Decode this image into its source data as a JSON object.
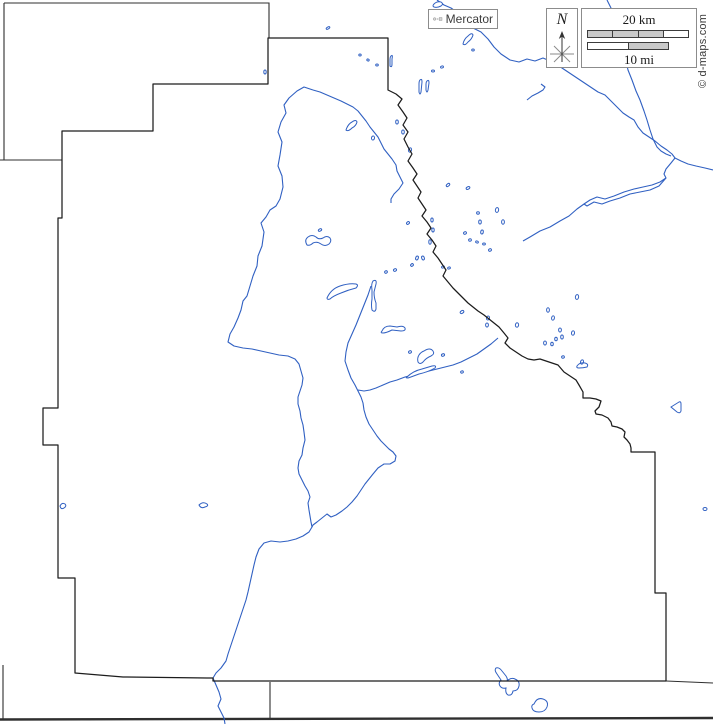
{
  "legend": {
    "projection": {
      "label": "Mercator"
    },
    "compass": {
      "label": "N"
    },
    "scale": {
      "km_label": "20 km",
      "mi_label": "10 mi",
      "km_segments": [
        "#c9c9c9",
        "#c9c9c9",
        "#c9c9c9",
        "#ffffff"
      ],
      "mi_segments": [
        "#ffffff",
        "#c9c9c9"
      ]
    },
    "copyright": "© d-maps.com"
  },
  "colors": {
    "river": "#3060c2",
    "water_fill": "#ffffff",
    "boundary": "#1c1c1c",
    "neighbor": "#2f2f2f",
    "legend_border": "#8c8c8c",
    "icon_fill": "#d4d4d4",
    "icon_stroke": "#6e6e6e"
  },
  "geometry": {
    "county_boundary": {
      "d": "M388 38 L388 90 L396 94 L402 99 L398 105 L403 112 L407 118 L403 125 L408 132 L404 139 L408 147 L412 154 L408 161 L413 168 L417 174 L413 180 L417 186 L421 192 L418 198 L422 204 L426 210 L422 216 L427 222 L431 228 L427 234 L432 240 L436 246 L433 252 L438 258 L442 264 L446 270 L443 276 L448 282 L453 288 L458 293 L463 298 L468 303 L473 307 L478 311 L484 315 L489 319 L494 323 L499 327 L504 333 L508 338 L505 343 L510 348 L516 352 L522 356 L528 359 L534 360 L540 359 L546 361 L552 363 L558 365 L564 372 L570 376 L576 380 L579 385 L583 392 L583 398 L590 398 L596 399 L601 401 L599 407 L595 411 L596 414 L602 415 L608 418 L611 422 L612 426 L617 427 L622 429 L625 432 L624 437 L627 440 L630 444 L631 448 L631 452 L655 452 L655 593 L666 593 L666 681 L213 681 L213 678 L207 678 L123 677 L75 673 L75 578 L58 578 L58 445 L43 445 L43 408 L58 408 L58 218 L62 218 L62 131 L153 131 L153 84 L268 84 L268 38 Z",
      "width": 1.25
    },
    "neighbor_lines": [
      {
        "name": "north-neighbor-top",
        "d": "M4 3 L269 3 L269 38",
        "w": 1.1
      },
      {
        "name": "northwest-edge",
        "d": "M4 3 L4 160",
        "w": 1.1
      },
      {
        "name": "west-neighbor",
        "d": "M0 160 L62 160",
        "w": 1.1
      },
      {
        "name": "southeast-extension",
        "d": "M666 681 L713 683",
        "w": 1.1
      },
      {
        "name": "south-neighbor-vertical",
        "d": "M270 682 L270 719",
        "w": 1.1
      },
      {
        "name": "southwest-edge",
        "d": "M3 665 L3 719",
        "w": 1.1
      },
      {
        "name": "south-thick-line",
        "d": "M0 719.5 L713 718",
        "w": 2.4
      }
    ],
    "rivers": [
      {
        "name": "northeast-main-river",
        "points": "437,0 444,5 451,8 458,13 465,21 473,28 481,32 488,39 494,47 501,54 510,60 519,62 527,59 535,61 543,58 550,61 556,64 562,68 568,72 574,76 580,80 586,84 592,88 598,92 605,95 612,102 618,108 623,113 629,117 634,120 638,127 643,133 649,137 655,141 661,146 667,150 672,154 675,158 681,161 688,164 696,166 705,168 713,170"
      },
      {
        "name": "north-tributary",
        "points": "607,0 611,8 615,14 619,22 622,32 620,42 624,52 626,62 628,70 632,80 636,91 640,100 644,111 647,120 650,130 653,139 657,147 661,151 666,154 671,156"
      },
      {
        "name": "southwest-branch",
        "points": "675,158 671,163 666,169 664,174 666,178 660,182 652,185 643,187 634,189 624,192 614,196 605,199 597,197 590,200 584,204 577,209 569,216 560,221 550,227 540,231 530,237 523,241"
      },
      {
        "name": "southwest-branch-braid",
        "points": "666,178 659,186 650,190 640,192 630,194 620,198 610,201 602,204 594,202 587,206 584,204"
      },
      {
        "name": "west-main-river",
        "points": "313,90 304,87 297,91 289,98 284,105 286,113 281,122 278,132 282,142 280,155 278,166 282,176 283,187 280,199 276,206 270,210 266,217 261,223 264,232 262,246 258,256 257,266 253,276 250,286 247,296 243,301 241,310 238,318 234,327 230,334 228,342 234,346 243,348 252,349 261,351 270,353 279,355 288,356 295,359 299,364 301,371 303,378 302,385 300,391 298,397 298,404 300,411 301,418 303,425 304,432 305,440 303,448 302,455 299,461 298,468 299,474 302,480 305,486 308,491 310,497 308,503 309,510 310,516 311,522 312,527 309,532 303,536 296,539 288,541 280,542 271,541 264,543 259,549 256,557 254,565 252,574 250,583 248,592 246,600 243,609 240,618 237,627 234,636 231,645 228,654 226,661 221,668 216,673 213,678 216,685 219,692 221,699 218,706 221,712 224,718 225,724"
      },
      {
        "name": "west-river-east-leg",
        "points": "313,90 320,92 327,95 334,98 341,101 347,104 353,107 358,111 362,116 366,121 370,127 374,132 378,137 381,143 384,149 388,154 392,159 396,165 397,171 400,177 403,183 399,189 394,194 391,199 391,203"
      },
      {
        "name": "center-river",
        "points": "371,286 368,295 364,305 360,315 356,325 352,334 348,343 346,352 345,361 348,370 351,378 355,385 358,391 361,397 363,403 364,410 366,417 369,424 373,430 377,436 381,441 385,445 389,449 393,452 396,456 395,461 390,464 384,464 378,468 373,474 369,479 365,484 361,490 357,496 352,502 347,507 342,511 336,515 331,517 327,514 322,518 317,522 313,525 312,527"
      },
      {
        "name": "southwest-feeder",
        "points": "498,338 491,344 484,349 477,354 469,358 461,362 453,365 445,367 437,369 429,371 421,373 413,375 405,377 397,380 390,382 383,385 376,388 370,390 364,391 358,390"
      },
      {
        "name": "small-squiggle-stream",
        "points": "527,100 532,96 538,93 543,90 545,87 541,84"
      }
    ],
    "lake_paths": [
      {
        "name": "dumbbell-lake",
        "d": "M307 245 Q304 240 308 237 Q312 234 316 237 Q319 240 323 238 Q327 235 330 238 Q332 241 329 244 Q325 247 321 244 Q317 241 313 243 Q310 246 307 245 Z"
      },
      {
        "name": "banana-lake",
        "d": "M327 298 Q331 289 340 286 Q349 283 356 284 Q359 285 356 288 Q348 290 341 293 Q333 296 330 299 Q327 300 327 298 Z"
      },
      {
        "name": "vertical-sliver-lake",
        "d": "M373 281 Q377 279 376 284 L374 292 Q374 298 376 303 L376 309 Q375 313 372 310 Q371 305 372 299 L372 290 Q371 284 373 281 Z"
      },
      {
        "name": "horizontal-sliver-lake",
        "d": "M382 331 Q384 326 390 326 L397 327 Q403 325 405 328 Q406 331 401 331 L392 330 Q386 333 383 333 Q380 333 382 331 Z"
      },
      {
        "name": "c-curl-lake",
        "d": "M424 351 Q430 347 433 351 Q435 354 431 356 Q426 358 423 362 Q420 365 418 362 Q417 358 419 355 Q421 352 424 351 Z"
      },
      {
        "name": "thin-banana-lake",
        "d": "M407 377 Q413 371 422 369 L432 366 Q437 365 435 368 Q428 372 419 374 Q411 377 408 378 Q405 378 407 377 Z"
      },
      {
        "name": "triangle-lake",
        "d": "M671 407 L679 402 Q681 401 681 404 L681 411 Q680 414 677 412 Z"
      },
      {
        "name": "butterfly-lake",
        "d": "M496 668 Q499 667 502 671 L506 676 Q508 679 507 681 Q511 677 515 679 Q520 681 519 686 Q518 691 513 691 Q512 696 508 695 Q505 693 506 688 Q502 689 500 686 Q498 683 501 680 L497 674 Q494 670 496 668 Z"
      },
      {
        "name": "heart-lake",
        "d": "M534 704 Q537 697 543 699 Q549 701 547 707 Q545 712 539 712 Q533 712 532 708 Q531 705 534 704 Z"
      },
      {
        "name": "tiny-west-sliver",
        "d": "M60 506 Q62 502 65 504 Q67 506 64 508 Q61 510 60 506 Z"
      },
      {
        "name": "tiny-center-sliver",
        "d": "M199 505 Q203 501 207 504 Q209 506 205 507 Q201 509 199 505 Z"
      },
      {
        "name": "nw-diagonal-sliver",
        "d": "M346 130 Q348 124 352 122 Q356 119 357 122 Q356 126 352 128 Q348 132 346 130 Z"
      },
      {
        "name": "paired-sliver-a",
        "d": "M420 80 Q422 78 422 82 L421 92 Q420 96 419 92 L419 84 Q419 81 420 80 Z"
      },
      {
        "name": "paired-sliver-b",
        "d": "M427 81 Q429 79 429 83 L428 90 Q427 94 426 90 L426 84 Q426 82 427 81 Z"
      },
      {
        "name": "top-diagonal-sliver",
        "d": "M463 44 Q464 39 468 36 Q472 32 473 35 Q472 39 468 42 Q465 46 463 44 Z"
      },
      {
        "name": "small-vertical-sliver",
        "d": "M391 56 Q393 54 392 59 L392 64 Q392 68 390 66 Q390 62 390 59 Q390 57 391 56 Z"
      },
      {
        "name": "east-curved-sliver",
        "d": "M577 366 Q580 362 585 363 Q589 364 587 367 Q583 368 579 368 Q576 368 577 366 Z"
      },
      {
        "name": "top-curl-lake",
        "d": "M434 4 Q437 1 441 2 Q444 4 441 6 Q437 8 434 7 Q432 6 434 4 Z"
      }
    ],
    "lake_dots": [
      [
        265,
        72,
        1.2,
        2,
        0
      ],
      [
        328,
        28,
        2,
        1,
        -30
      ],
      [
        360,
        55,
        1.2,
        1,
        0
      ],
      [
        368,
        60,
        1.2,
        1,
        20
      ],
      [
        377,
        65,
        1.3,
        1,
        0
      ],
      [
        433,
        71,
        1.5,
        1,
        0
      ],
      [
        442,
        67,
        1.5,
        1,
        -20
      ],
      [
        473,
        50,
        1.3,
        1,
        0
      ],
      [
        373,
        138,
        1.5,
        2,
        10
      ],
      [
        397,
        122,
        1.3,
        2,
        0
      ],
      [
        403,
        132,
        1.3,
        2,
        0
      ],
      [
        410,
        150,
        1.5,
        2.2,
        15
      ],
      [
        448,
        185,
        2,
        1.2,
        -40
      ],
      [
        468,
        188,
        2,
        1.2,
        -30
      ],
      [
        497,
        210,
        1.6,
        2.4,
        10
      ],
      [
        503,
        222,
        1.4,
        2.2,
        0
      ],
      [
        478,
        213,
        1.4,
        1.2,
        0
      ],
      [
        480,
        222,
        1.3,
        2,
        0
      ],
      [
        482,
        232,
        1.3,
        2,
        10
      ],
      [
        465,
        233,
        1.5,
        1.2,
        -30
      ],
      [
        470,
        240,
        1.4,
        1.2,
        -20
      ],
      [
        477,
        242,
        1.4,
        1,
        20
      ],
      [
        484,
        244,
        1.4,
        1,
        0
      ],
      [
        490,
        250,
        1.5,
        1.2,
        -30
      ],
      [
        432,
        220,
        1.2,
        2,
        0
      ],
      [
        433,
        230,
        1.2,
        2,
        0
      ],
      [
        430,
        242,
        1.2,
        2.2,
        0
      ],
      [
        408,
        223,
        1.6,
        1.2,
        -40
      ],
      [
        417,
        258,
        1.3,
        2,
        20
      ],
      [
        423,
        258,
        1.3,
        2,
        -20
      ],
      [
        412,
        265,
        1.5,
        1.2,
        -40
      ],
      [
        443,
        267,
        1.5,
        1,
        -20
      ],
      [
        449,
        268,
        1.4,
        1,
        -20
      ],
      [
        395,
        270,
        1.6,
        1.2,
        -30
      ],
      [
        386,
        272,
        1.4,
        1.2,
        -30
      ],
      [
        462,
        312,
        2,
        1.3,
        -35
      ],
      [
        488,
        318,
        1.5,
        2,
        15
      ],
      [
        487,
        325,
        1.4,
        2,
        0
      ],
      [
        517,
        325,
        1.6,
        2.2,
        10
      ],
      [
        548,
        310,
        1.4,
        2.2,
        0
      ],
      [
        553,
        318,
        1.4,
        2.2,
        10
      ],
      [
        560,
        330,
        1.4,
        2,
        0
      ],
      [
        562,
        337,
        1.3,
        2,
        0
      ],
      [
        556,
        339,
        1.3,
        1.8,
        0
      ],
      [
        545,
        343,
        1.4,
        2,
        0
      ],
      [
        552,
        344,
        1.3,
        1.8,
        0
      ],
      [
        573,
        333,
        1.5,
        2.2,
        10
      ],
      [
        577,
        297,
        1.6,
        2.4,
        10
      ],
      [
        563,
        357,
        1.4,
        1.2,
        -20
      ],
      [
        582,
        362,
        1.5,
        2.2,
        15
      ],
      [
        443,
        355,
        1.6,
        1.2,
        -20
      ],
      [
        410,
        352,
        1.5,
        1.2,
        -30
      ],
      [
        462,
        372,
        1.4,
        1.1,
        -20
      ],
      [
        320,
        230,
        1.8,
        1.1,
        -30
      ],
      [
        705,
        509,
        2,
        1.5,
        0
      ]
    ]
  }
}
